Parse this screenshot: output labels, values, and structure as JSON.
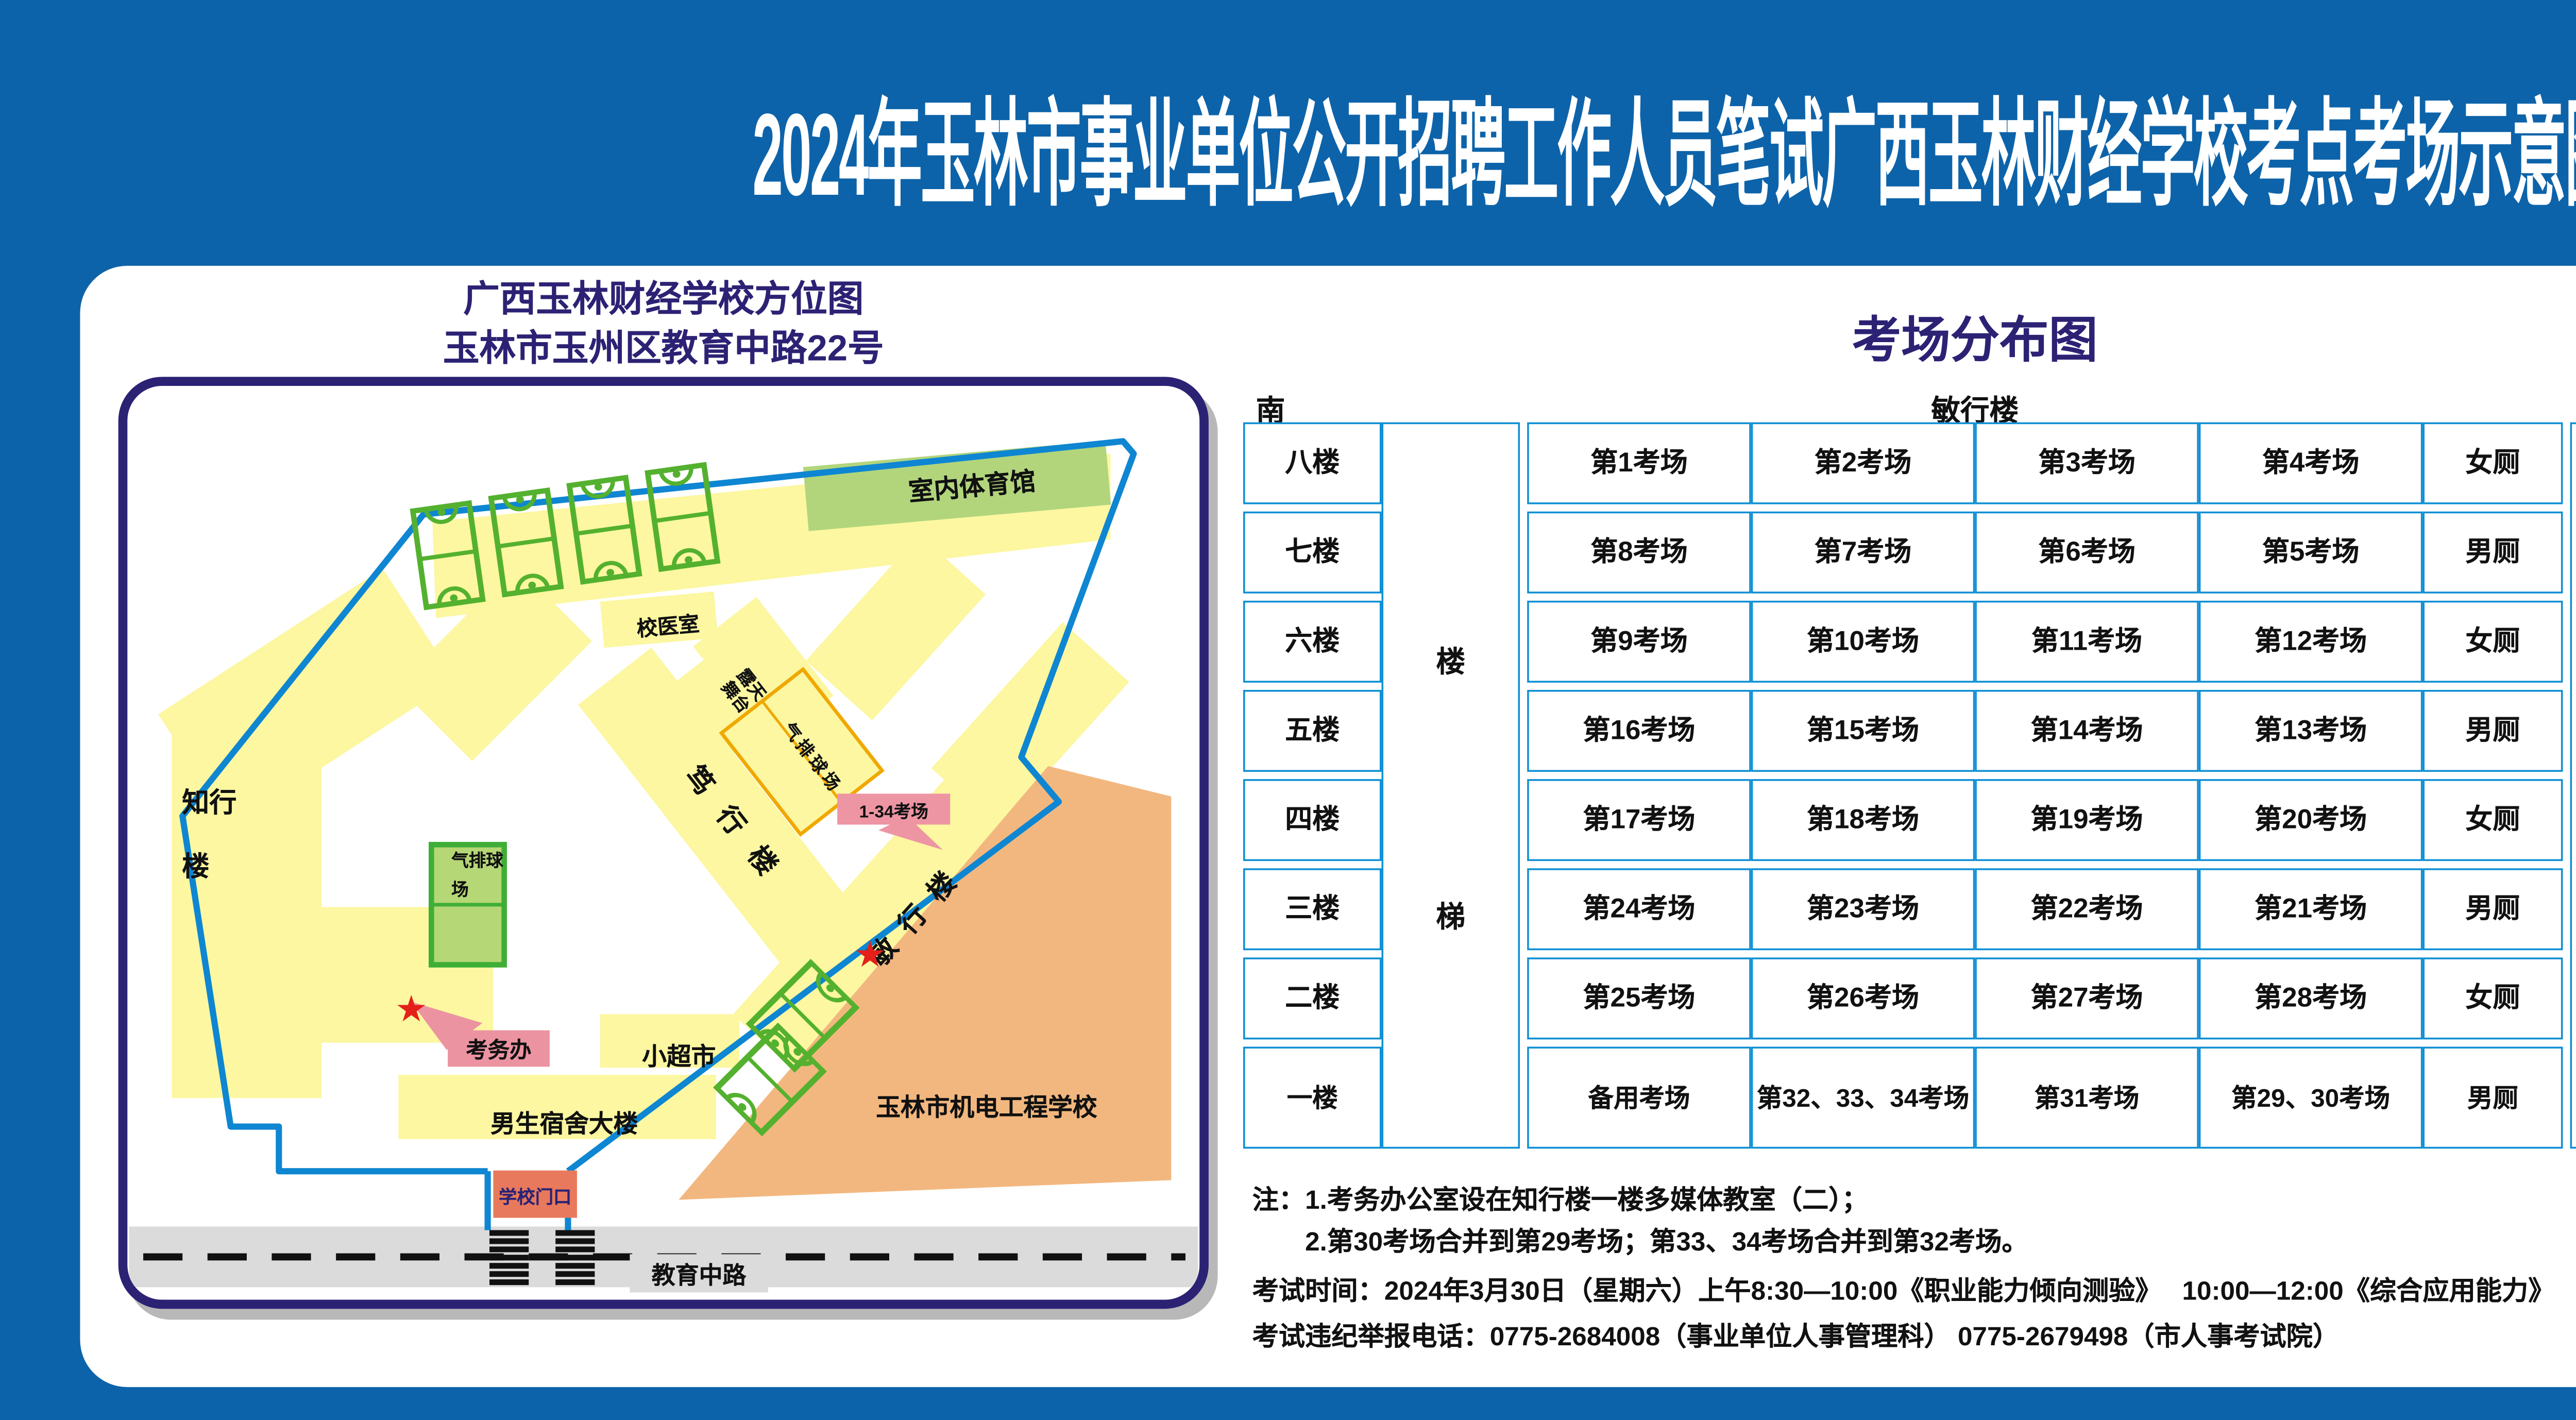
{
  "title": "2024年玉林市事业单位公开招聘工作人员笔试广西玉林财经学校考点考场示意图",
  "panel": {
    "map": {
      "title_line1": "广西玉林财经学校方位图",
      "title_line2": "玉林市玉州区教育中路22号",
      "labels": {
        "gym": "室内体育馆",
        "clinic": "校医室",
        "stage_line1": "露天",
        "stage_line2": "舞台",
        "duxing": "笃行楼",
        "volleyball_east": "气排球场",
        "volleyball_west": "气排球场",
        "zhixing": "知行楼",
        "minxing": "敏行楼",
        "exam_callout": "1-34考场",
        "exam_office": "考务办",
        "supermarket": "小超市",
        "dorm": "男生宿舍大楼",
        "gate": "学校门口",
        "road": "教育中路",
        "neighbor": "玉林市机电工程学校",
        "star": "★"
      }
    },
    "distribution": {
      "title": "考场分布图",
      "compass_south": "南",
      "compass_north": "北",
      "building_header": "敏行楼",
      "stairs_top": "楼",
      "stairs_bottom": "梯",
      "rows": [
        {
          "floor": "八楼",
          "rooms": [
            "第1考场",
            "第2考场",
            "第3考场",
            "第4考场"
          ],
          "toilet": "女厕"
        },
        {
          "floor": "七楼",
          "rooms": [
            "第8考场",
            "第7考场",
            "第6考场",
            "第5考场"
          ],
          "toilet": "男厕"
        },
        {
          "floor": "六楼",
          "rooms": [
            "第9考场",
            "第10考场",
            "第11考场",
            "第12考场"
          ],
          "toilet": "女厕"
        },
        {
          "floor": "五楼",
          "rooms": [
            "第16考场",
            "第15考场",
            "第14考场",
            "第13考场"
          ],
          "toilet": "男厕"
        },
        {
          "floor": "四楼",
          "rooms": [
            "第17考场",
            "第18考场",
            "第19考场",
            "第20考场"
          ],
          "toilet": "女厕"
        },
        {
          "floor": "三楼",
          "rooms": [
            "第24考场",
            "第23考场",
            "第22考场",
            "第21考场"
          ],
          "toilet": "男厕"
        },
        {
          "floor": "二楼",
          "rooms": [
            "第25考场",
            "第26考场",
            "第27考场",
            "第28考场"
          ],
          "toilet": "女厕"
        },
        {
          "floor": "一楼",
          "rooms": [
            "备用考场",
            "第32、33、34考场",
            "第31考场",
            "第29、30考场"
          ],
          "toilet": "男厕"
        }
      ]
    },
    "notes": {
      "note1": "注：1.考务办公室设在知行楼一楼多媒体教室（二）；",
      "note2": "2.第30考场合并到第29考场；第33、34考场合并到第32考场。",
      "time": "考试时间：2024年3月30日（星期六）上午8:30—10:00《职业能力倾向测验》　 10:00—12:00《综合应用能力》",
      "hotline": "考试违纪举报电话：0775-2684008（事业单位人事管理科） 0775-2679498（市人事考试院）"
    }
  },
  "colors": {
    "background_blue": "#0d63a9",
    "title_navy": "#2c2274",
    "table_border_blue": "#0e8fd5",
    "building_yellow": "#fcf7a0",
    "court_green_fill": "#b2d57c",
    "court_green_line": "#54b12f",
    "neighbor_orange": "#f2b77f",
    "callout_pink": "#ee95a4",
    "gate_salmon": "#e8795c",
    "road_gray": "#dcdbdb",
    "star_red": "#e32119"
  }
}
